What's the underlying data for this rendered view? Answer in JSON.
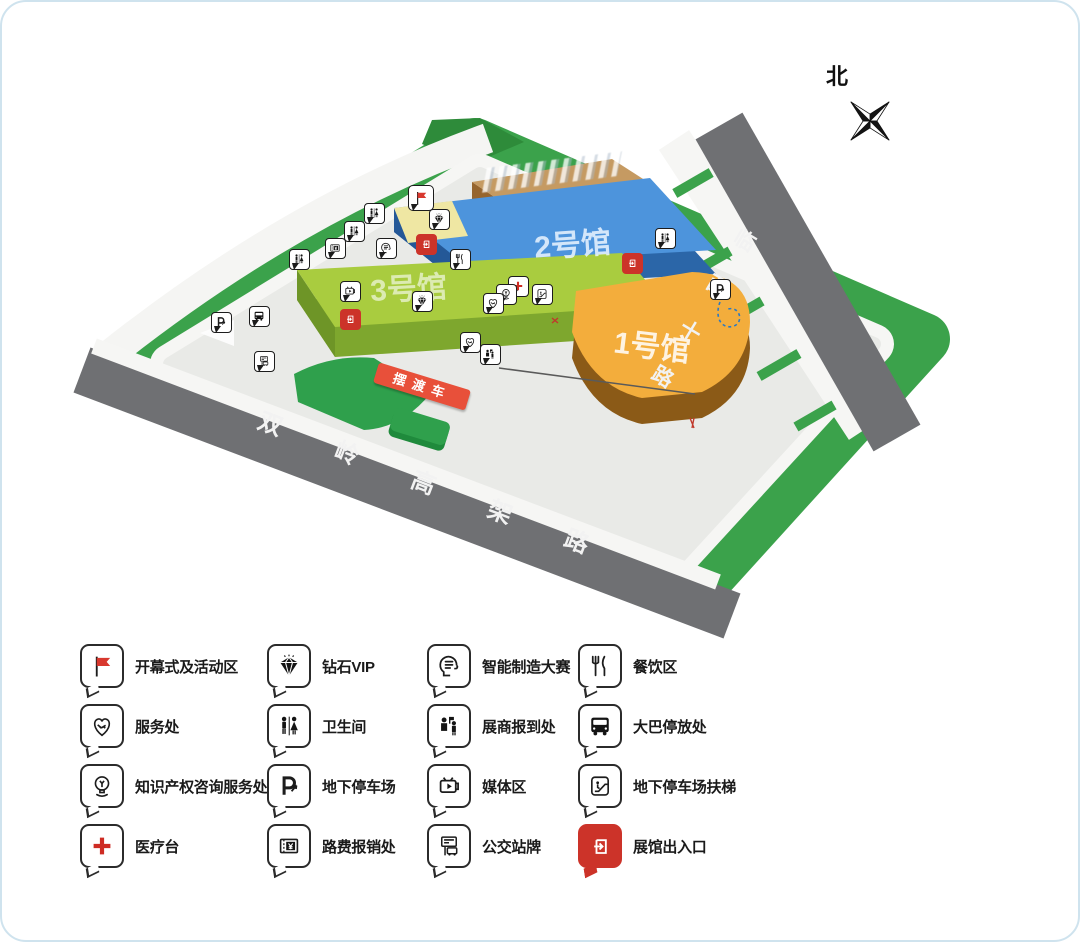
{
  "compass": {
    "north_label": "北"
  },
  "map": {
    "buildings": [
      {
        "id": "hall1",
        "label": "1号馆",
        "color": "#F3AD3C"
      },
      {
        "id": "hall2",
        "label": "2号馆",
        "color": "#4D94DC"
      },
      {
        "id": "hall3",
        "label": "3号馆",
        "color": "#A9CC3F"
      },
      {
        "id": "hotel",
        "label": "",
        "color": "#C59A62"
      }
    ],
    "roads": [
      {
        "name": "临西十路"
      },
      {
        "name": "双岭高架路"
      }
    ],
    "shuttle_banner": "摆渡车",
    "markers": [
      {
        "icon": "toilet",
        "x": 372,
        "y": 211
      },
      {
        "icon": "diamond",
        "x": 437,
        "y": 217
      },
      {
        "icon": "flag",
        "x": 419,
        "y": 196,
        "big": true
      },
      {
        "icon": "toilet",
        "x": 352,
        "y": 229
      },
      {
        "icon": "toll",
        "x": 333,
        "y": 246
      },
      {
        "icon": "ai-head",
        "x": 384,
        "y": 246
      },
      {
        "icon": "exit",
        "x": 424,
        "y": 242,
        "red": true
      },
      {
        "icon": "toilet",
        "x": 297,
        "y": 257
      },
      {
        "icon": "dining",
        "x": 458,
        "y": 257
      },
      {
        "icon": "toilet",
        "x": 663,
        "y": 236
      },
      {
        "icon": "exit",
        "x": 630,
        "y": 261,
        "red": true
      },
      {
        "icon": "media",
        "x": 348,
        "y": 289
      },
      {
        "icon": "exit",
        "x": 348,
        "y": 317,
        "red": true
      },
      {
        "icon": "diamond",
        "x": 420,
        "y": 299
      },
      {
        "icon": "medical",
        "x": 516,
        "y": 284
      },
      {
        "icon": "bulb",
        "x": 504,
        "y": 292
      },
      {
        "icon": "handshake",
        "x": 491,
        "y": 301
      },
      {
        "icon": "escalator",
        "x": 540,
        "y": 292
      },
      {
        "icon": "bus",
        "x": 257,
        "y": 314
      },
      {
        "icon": "parking",
        "x": 219,
        "y": 320
      },
      {
        "icon": "busstop",
        "x": 262,
        "y": 359
      },
      {
        "icon": "handshake",
        "x": 468,
        "y": 340
      },
      {
        "icon": "regdesk",
        "x": 488,
        "y": 352
      },
      {
        "icon": "parking",
        "x": 718,
        "y": 287
      }
    ]
  },
  "legend": {
    "items": [
      {
        "icon": "flag",
        "label": "开幕式及活动区"
      },
      {
        "icon": "diamond",
        "label": "钻石VIP"
      },
      {
        "icon": "ai-head",
        "label": "智能制造大赛"
      },
      {
        "icon": "dining",
        "label": "餐饮区"
      },
      {
        "icon": "handshake",
        "label": "服务处"
      },
      {
        "icon": "toilet",
        "label": "卫生间"
      },
      {
        "icon": "regdesk",
        "label": "展商报到处"
      },
      {
        "icon": "bus",
        "label": "大巴停放处"
      },
      {
        "icon": "bulb",
        "label": "知识产权咨询服务处"
      },
      {
        "icon": "parking",
        "label": "地下停车场"
      },
      {
        "icon": "media",
        "label": "媒体区"
      },
      {
        "icon": "escalator",
        "label": "地下停车场扶梯"
      },
      {
        "icon": "medical",
        "label": "医疗台"
      },
      {
        "icon": "toll",
        "label": "路费报销处"
      },
      {
        "icon": "busstop",
        "label": "公交站牌"
      },
      {
        "icon": "exit",
        "label": "展馆出入口"
      }
    ]
  },
  "colors": {
    "site_green": "#3BA24B",
    "dark_green": "#2E8B3A",
    "road_gray": "#6F7073",
    "plaza_gray": "#E9EAE7",
    "banner_red": "#E8503A",
    "marker_red": "#CC3329",
    "hall1_orange": "#F3AD3C",
    "hall2_blue": "#4D94DC",
    "hall3_green": "#A9CC3F",
    "hotel_tan": "#C59A62",
    "ceremony_yellow": "#EFE7A3"
  }
}
